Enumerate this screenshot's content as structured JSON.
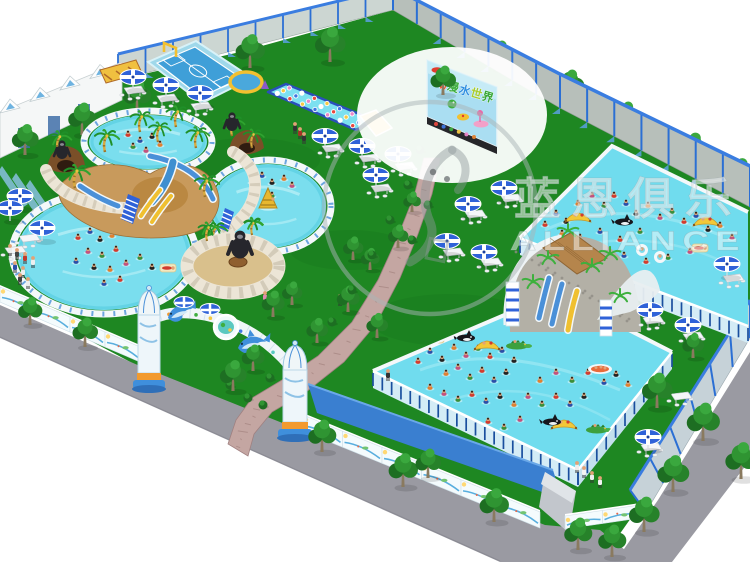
{
  "title": "Inflatable water park 3D plan render",
  "billboard": {
    "text": "动漫水世界",
    "char_colors": [
      "#f4502e",
      "#3fae3f",
      "#2f8fe0",
      "#a7cc2f",
      "#37a837"
    ]
  },
  "watermark": {
    "chinese": "蓝恩俱乐",
    "english": "ALLIANCE"
  },
  "colors": {
    "grass": "#1e8722",
    "water": "#70dcee",
    "water_rim": "#f4f8fa",
    "road": "#9a9aa2",
    "path": "#c4a6a2",
    "roof_blue": "#3a7fd0",
    "umbrella_blue": "#2f62d8",
    "goal_yellow": "#f2c030",
    "tree_dark": "#1d6e22",
    "tree_light": "#2f9432",
    "wall_grey": "#b7bfba",
    "frame_blue": "#1a4f9e",
    "slide_tan": "#c89a5c"
  },
  "scene": {
    "trees_top_outside": [
      [
        500,
        70,
        1.0
      ],
      [
        570,
        102,
        1.1
      ],
      [
        626,
        134,
        1.1
      ],
      [
        693,
        168,
        1.2
      ],
      [
        740,
        192,
        1.15
      ]
    ],
    "trees_top_inside": [
      [
        330,
        62,
        1.2
      ],
      [
        250,
        68,
        1.15
      ],
      [
        197,
        90,
        1.15
      ],
      [
        137,
        112,
        1.1
      ],
      [
        82,
        135,
        1.1
      ],
      [
        25,
        155,
        1.05
      ]
    ],
    "tree_mid": [
      [
        443,
        95,
        1.0
      ]
    ],
    "trees_inside": [
      [
        273,
        317,
        0.9
      ],
      [
        292,
        305,
        0.8
      ],
      [
        317,
        343,
        0.85
      ],
      [
        348,
        312,
        0.9
      ],
      [
        353,
        260,
        0.8
      ],
      [
        370,
        270,
        0.75
      ],
      [
        377,
        338,
        0.85
      ],
      [
        398,
        248,
        0.8
      ],
      [
        412,
        212,
        0.7
      ],
      [
        693,
        358,
        0.85
      ]
    ],
    "trees_bottom_outside": [
      [
        30,
        325,
        0.95
      ],
      [
        85,
        347,
        1.0
      ],
      [
        233,
        391,
        1.05
      ],
      [
        253,
        371,
        0.9
      ],
      [
        322,
        452,
        1.1
      ],
      [
        403,
        487,
        1.15
      ],
      [
        428,
        478,
        1.0
      ],
      [
        494,
        522,
        1.15
      ],
      [
        578,
        550,
        1.1
      ]
    ],
    "trees_road_right": [
      [
        657,
        408,
        1.2
      ],
      [
        703,
        441,
        1.3
      ],
      [
        741,
        479,
        1.25
      ],
      [
        673,
        492,
        1.25
      ],
      [
        644,
        532,
        1.2
      ],
      [
        612,
        557,
        1.1
      ]
    ],
    "palms": [
      [
        75,
        188,
        1.0
      ],
      [
        58,
        152,
        0.9
      ],
      [
        105,
        152,
        0.95
      ],
      [
        140,
        132,
        0.9
      ],
      [
        158,
        142,
        0.85
      ],
      [
        176,
        127,
        0.9
      ],
      [
        196,
        148,
        0.9
      ],
      [
        205,
        197,
        0.95
      ],
      [
        214,
        243,
        0.9
      ],
      [
        232,
        136,
        0.85
      ],
      [
        252,
        148,
        0.8
      ],
      [
        207,
        241,
        0.8
      ],
      [
        252,
        235,
        0.75
      ]
    ],
    "gorillas": [
      [
        62,
        152,
        1.0
      ],
      [
        232,
        124,
        1.0
      ],
      [
        240,
        248,
        1.5
      ]
    ],
    "umbrellas": [
      [
        133,
        77
      ],
      [
        166,
        85
      ],
      [
        200,
        93
      ],
      [
        325,
        136
      ],
      [
        20,
        196
      ],
      [
        10,
        208
      ],
      [
        42,
        228
      ],
      [
        362,
        146
      ],
      [
        398,
        154
      ],
      [
        376,
        175
      ],
      [
        504,
        188
      ],
      [
        468,
        204
      ],
      [
        447,
        241
      ],
      [
        484,
        252
      ],
      [
        727,
        264
      ],
      [
        650,
        310
      ],
      [
        688,
        325
      ],
      [
        648,
        437
      ]
    ],
    "tables": [
      [
        133,
        92
      ],
      [
        166,
        100
      ],
      [
        200,
        108
      ],
      [
        331,
        150
      ],
      [
        28,
        240
      ],
      [
        14,
        252
      ],
      [
        368,
        160
      ],
      [
        404,
        168
      ],
      [
        380,
        190
      ],
      [
        510,
        200
      ],
      [
        474,
        216
      ],
      [
        452,
        254
      ],
      [
        490,
        264
      ],
      [
        732,
        280
      ],
      [
        652,
        322
      ],
      [
        692,
        338
      ],
      [
        650,
        449
      ],
      [
        680,
        398
      ]
    ],
    "bushes": [
      [
        420,
        150
      ],
      [
        408,
        185
      ],
      [
        390,
        220
      ],
      [
        372,
        255
      ],
      [
        352,
        290
      ],
      [
        332,
        322
      ],
      [
        300,
        352
      ],
      [
        270,
        378
      ],
      [
        248,
        398
      ],
      [
        440,
        170
      ],
      [
        428,
        205
      ],
      [
        412,
        240
      ],
      [
        230,
        385
      ],
      [
        263,
        405
      ]
    ],
    "people": [
      [
        295,
        134,
        "#333333"
      ],
      [
        300,
        139,
        "#a33327"
      ],
      [
        304,
        144,
        "#333333"
      ],
      [
        265,
        303,
        "#e08bb0"
      ],
      [
        340,
        306,
        "#c0392b"
      ],
      [
        10,
        256,
        "#eeeeee"
      ],
      [
        17,
        260,
        "#444444"
      ],
      [
        25,
        264,
        "#c0392b"
      ],
      [
        33,
        268,
        "#eeeeee"
      ],
      [
        15,
        273,
        "#2b4fa8"
      ],
      [
        23,
        278,
        "#eeeeee"
      ],
      [
        20,
        285,
        "#444444"
      ],
      [
        28,
        289,
        "#eeeeee"
      ],
      [
        577,
        473,
        "#eeeeee"
      ],
      [
        584,
        478,
        "#f4f4f4"
      ],
      [
        592,
        483,
        "#eeeeee"
      ],
      [
        600,
        488,
        "#f4f4f4"
      ],
      [
        388,
        381,
        "#333333"
      ]
    ],
    "swimmers": {
      "pool_top": [
        128,
        135,
        140,
        141,
        152,
        137,
        160,
        145,
        146,
        151,
        133,
        147
      ],
      "pool_left": [
        78,
        238,
        90,
        232,
        100,
        240,
        112,
        236,
        88,
        252,
        102,
        256,
        116,
        250,
        76,
        262,
        94,
        268,
        110,
        270,
        126,
        264,
        140,
        258,
        120,
        280,
        104,
        284,
        152,
        268
      ],
      "pool_right": [
        252,
        182,
        262,
        176,
        272,
        183,
        284,
        179,
        292,
        186,
        272,
        196
      ],
      "pool2": [
        545,
        225,
        556,
        214,
        566,
        222,
        578,
        204,
        592,
        196,
        604,
        206,
        614,
        196,
        626,
        204,
        636,
        214,
        648,
        206,
        660,
        218,
        672,
        212,
        684,
        222,
        696,
        216,
        708,
        230,
        720,
        226,
        732,
        238,
        640,
        232,
        620,
        240,
        600,
        232,
        580,
        238,
        562,
        234,
        690,
        252,
        668,
        258,
        646,
        262,
        624,
        256,
        602,
        262
      ],
      "pool3": [
        418,
        362,
        430,
        352,
        442,
        360,
        454,
        348,
        466,
        356,
        478,
        349,
        490,
        357,
        502,
        351,
        514,
        361,
        446,
        374,
        458,
        368,
        470,
        378,
        482,
        371,
        494,
        381,
        506,
        373,
        430,
        388,
        444,
        394,
        458,
        400,
        472,
        395,
        486,
        402,
        500,
        397,
        514,
        405,
        528,
        397,
        542,
        405,
        556,
        397,
        570,
        405,
        584,
        397,
        540,
        381,
        556,
        373,
        572,
        381,
        588,
        373,
        604,
        383,
        616,
        375,
        628,
        385,
        520,
        420,
        504,
        428,
        488,
        422,
        472,
        430
      ]
    },
    "floats": {
      "pool2": [
        [
          "banana",
          578,
          219
        ],
        [
          "banana",
          706,
          223
        ],
        [
          "orca",
          624,
          222
        ],
        [
          "ring",
          642,
          250
        ],
        [
          "ring",
          660,
          257
        ],
        [
          "raft",
          700,
          248
        ]
      ],
      "pool3": [
        [
          "banana",
          487,
          347
        ],
        [
          "banana",
          564,
          426
        ],
        [
          "orca",
          466,
          338
        ],
        [
          "orca",
          552,
          422
        ],
        [
          "croc",
          517,
          346
        ],
        [
          "croc",
          597,
          430
        ],
        [
          "boat",
          600,
          369
        ],
        [
          "raft",
          436,
          339
        ]
      ],
      "pool_left": [
        [
          "raft",
          168,
          268
        ]
      ],
      "pool_right": [
        [
          "cone",
          268,
          202
        ]
      ]
    }
  }
}
